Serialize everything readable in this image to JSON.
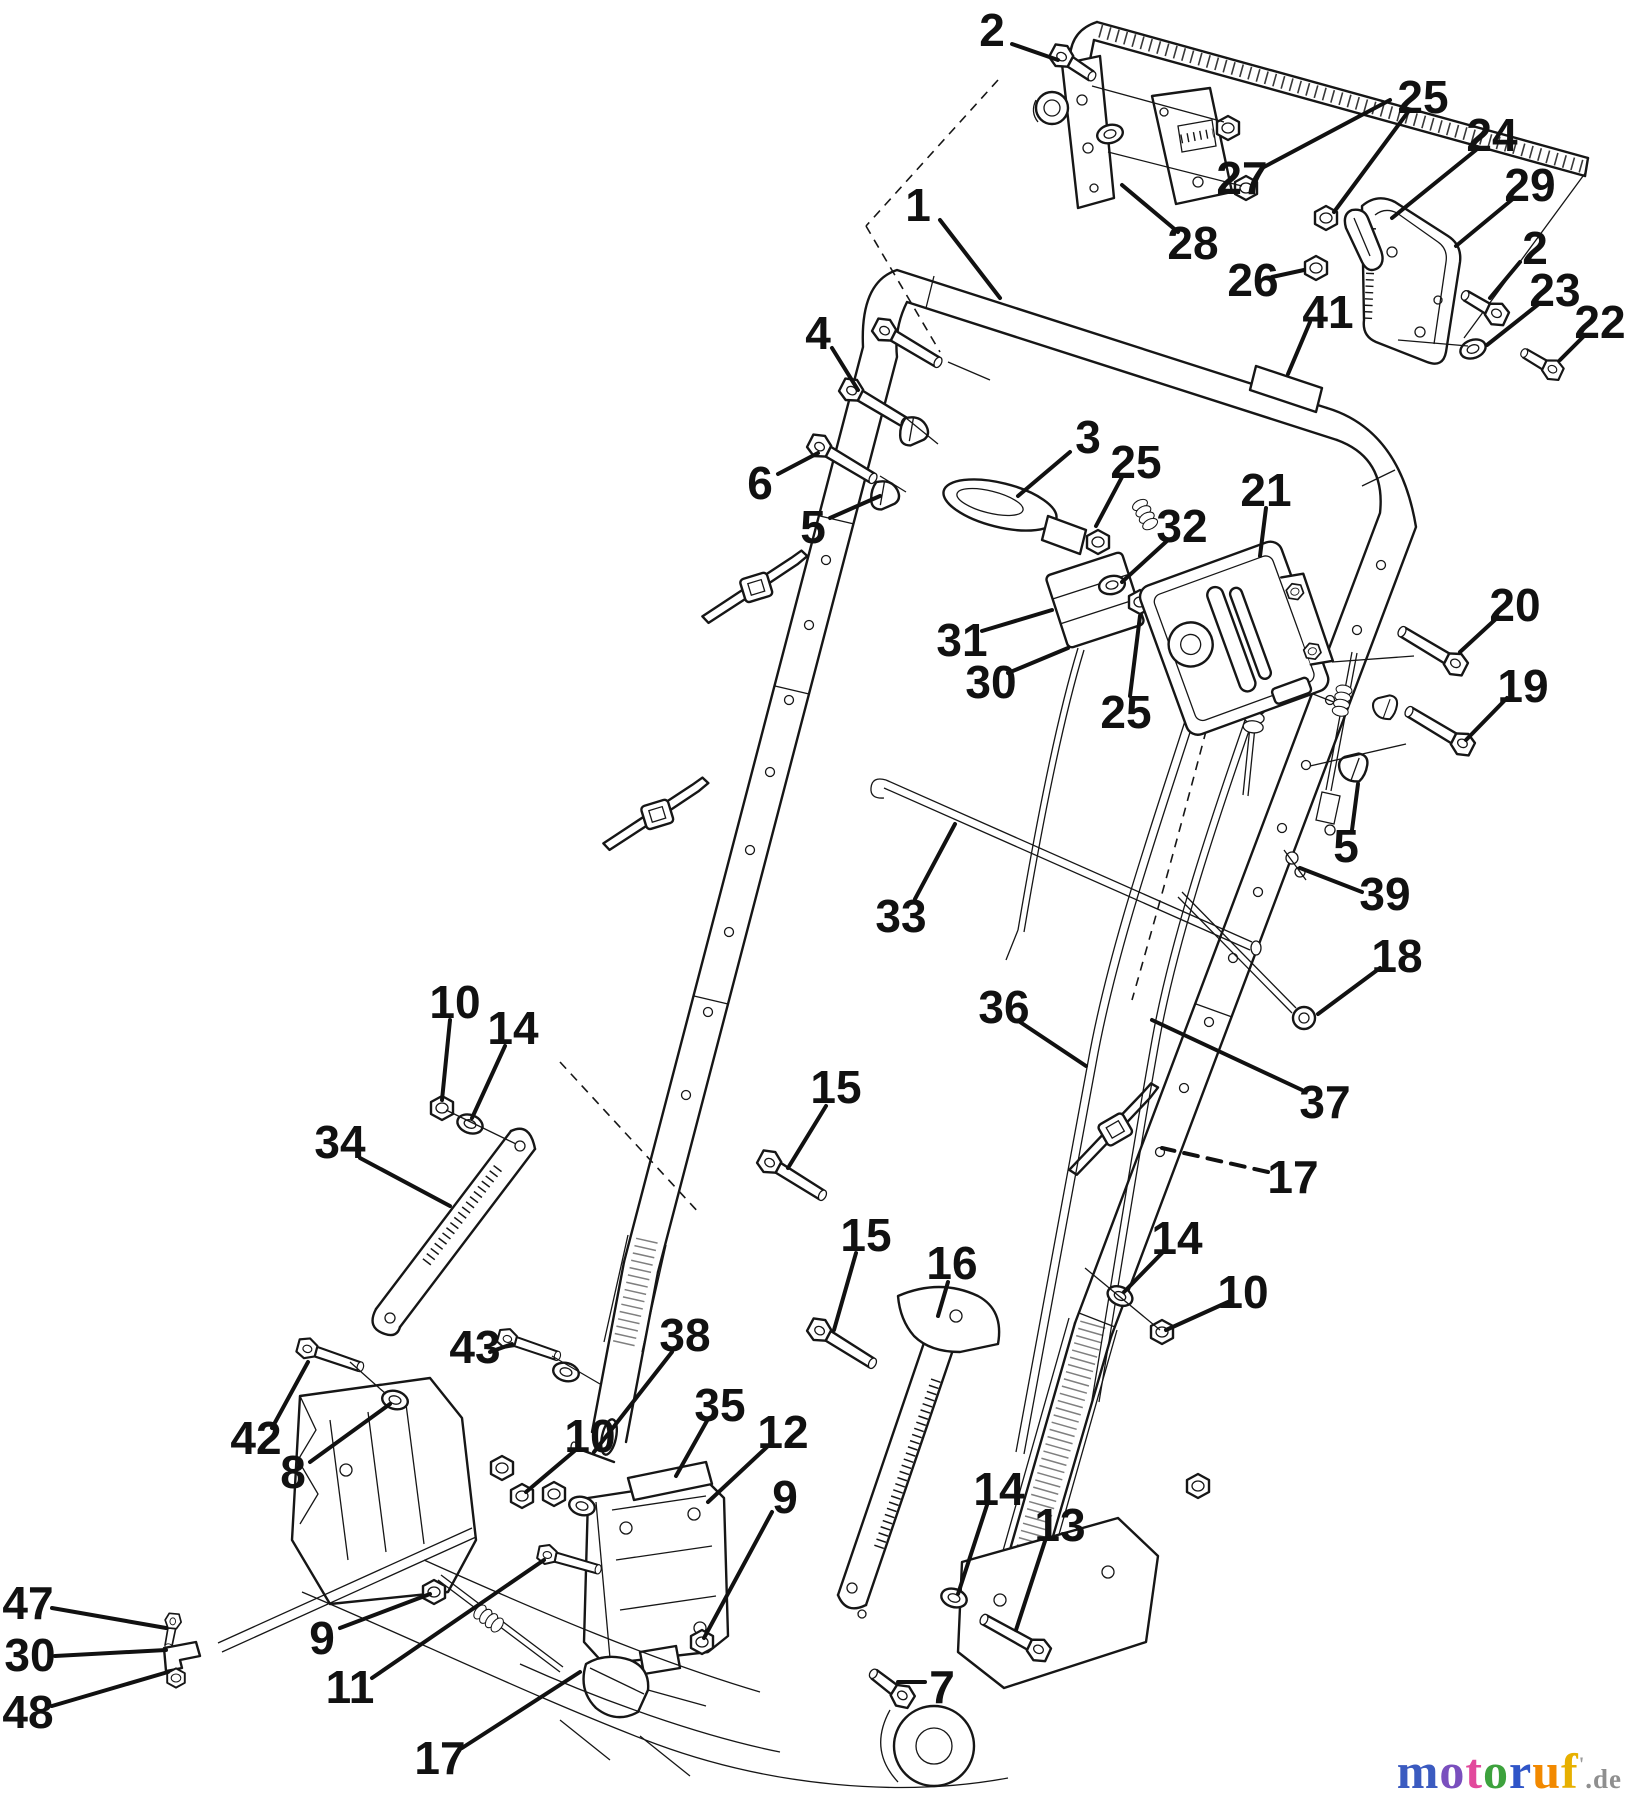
{
  "diagram": {
    "background": "#ffffff",
    "ink": "#161616",
    "callout_color": "#111111",
    "callouts": [
      {
        "part": "1",
        "x": 918,
        "y": 205,
        "leader": [
          [
            940,
            220
          ],
          [
            1000,
            298
          ]
        ]
      },
      {
        "part": "2",
        "x": 992,
        "y": 30,
        "leader": [
          [
            1012,
            44
          ],
          [
            1058,
            60
          ]
        ]
      },
      {
        "part": "2",
        "x": 1535,
        "y": 248,
        "leader": [
          [
            1520,
            262
          ],
          [
            1490,
            298
          ]
        ]
      },
      {
        "part": "3",
        "x": 1088,
        "y": 437,
        "leader": [
          [
            1070,
            452
          ],
          [
            1018,
            496
          ]
        ]
      },
      {
        "part": "4",
        "x": 818,
        "y": 333,
        "leader": [
          [
            832,
            348
          ],
          [
            858,
            390
          ]
        ]
      },
      {
        "part": "5",
        "x": 813,
        "y": 527,
        "leader": [
          [
            830,
            518
          ],
          [
            880,
            496
          ]
        ]
      },
      {
        "part": "5",
        "x": 1346,
        "y": 846,
        "leader": [
          [
            1352,
            830
          ],
          [
            1358,
            784
          ]
        ]
      },
      {
        "part": "6",
        "x": 760,
        "y": 483,
        "leader": [
          [
            778,
            474
          ],
          [
            818,
            453
          ]
        ]
      },
      {
        "part": "7",
        "x": 942,
        "y": 1687,
        "leader": [
          [
            925,
            1682
          ],
          [
            898,
            1682
          ]
        ]
      },
      {
        "part": "8",
        "x": 293,
        "y": 1472,
        "leader": [
          [
            310,
            1462
          ],
          [
            390,
            1404
          ]
        ]
      },
      {
        "part": "9",
        "x": 322,
        "y": 1638,
        "leader": [
          [
            340,
            1628
          ],
          [
            430,
            1594
          ]
        ]
      },
      {
        "part": "9",
        "x": 785,
        "y": 1497,
        "leader": [
          [
            772,
            1512
          ],
          [
            704,
            1638
          ]
        ]
      },
      {
        "part": "10",
        "x": 455,
        "y": 1002,
        "leader": [
          [
            450,
            1020
          ],
          [
            442,
            1100
          ]
        ]
      },
      {
        "part": "10",
        "x": 590,
        "y": 1436,
        "leader": [
          [
            578,
            1448
          ],
          [
            526,
            1492
          ]
        ]
      },
      {
        "part": "10",
        "x": 1243,
        "y": 1292,
        "leader": [
          [
            1228,
            1302
          ],
          [
            1166,
            1330
          ]
        ]
      },
      {
        "part": "11",
        "x": 350,
        "y": 1687,
        "leader": [
          [
            372,
            1678
          ],
          [
            544,
            1560
          ]
        ]
      },
      {
        "part": "12",
        "x": 783,
        "y": 1432,
        "leader": [
          [
            768,
            1446
          ],
          [
            708,
            1502
          ]
        ]
      },
      {
        "part": "13",
        "x": 1060,
        "y": 1525,
        "leader": [
          [
            1046,
            1538
          ],
          [
            1016,
            1630
          ]
        ]
      },
      {
        "part": "14",
        "x": 513,
        "y": 1028,
        "leader": [
          [
            505,
            1046
          ],
          [
            472,
            1118
          ]
        ]
      },
      {
        "part": "14",
        "x": 1177,
        "y": 1238,
        "leader": [
          [
            1165,
            1250
          ],
          [
            1124,
            1292
          ]
        ]
      },
      {
        "part": "14",
        "x": 999,
        "y": 1489,
        "leader": [
          [
            988,
            1502
          ],
          [
            958,
            1594
          ]
        ]
      },
      {
        "part": "15",
        "x": 836,
        "y": 1087,
        "leader": [
          [
            826,
            1106
          ],
          [
            788,
            1168
          ]
        ]
      },
      {
        "part": "15",
        "x": 866,
        "y": 1235,
        "leader": [
          [
            856,
            1253
          ],
          [
            834,
            1330
          ]
        ]
      },
      {
        "part": "16",
        "x": 952,
        "y": 1263,
        "leader": [
          [
            948,
            1282
          ],
          [
            938,
            1316
          ]
        ]
      },
      {
        "part": "17",
        "x": 1293,
        "y": 1177,
        "dashed": true,
        "leader": [
          [
            1268,
            1172
          ],
          [
            1162,
            1148
          ]
        ]
      },
      {
        "part": "17",
        "x": 440,
        "y": 1758,
        "leader": [
          [
            462,
            1748
          ],
          [
            580,
            1672
          ]
        ]
      },
      {
        "part": "18",
        "x": 1397,
        "y": 956,
        "leader": [
          [
            1380,
            968
          ],
          [
            1318,
            1014
          ]
        ]
      },
      {
        "part": "19",
        "x": 1523,
        "y": 686,
        "leader": [
          [
            1507,
            698
          ],
          [
            1466,
            740
          ]
        ]
      },
      {
        "part": "20",
        "x": 1515,
        "y": 605,
        "leader": [
          [
            1498,
            617
          ],
          [
            1460,
            652
          ]
        ]
      },
      {
        "part": "21",
        "x": 1266,
        "y": 490,
        "leader": [
          [
            1266,
            508
          ],
          [
            1260,
            556
          ]
        ]
      },
      {
        "part": "22",
        "x": 1600,
        "y": 322,
        "leader": [
          [
            1584,
            336
          ],
          [
            1560,
            360
          ]
        ]
      },
      {
        "part": "23",
        "x": 1555,
        "y": 290,
        "leader": [
          [
            1540,
            303
          ],
          [
            1487,
            345
          ]
        ]
      },
      {
        "part": "24",
        "x": 1492,
        "y": 135,
        "leader": [
          [
            1476,
            150
          ],
          [
            1392,
            218
          ]
        ]
      },
      {
        "part": "25",
        "x": 1423,
        "y": 97,
        "leader": [
          [
            1408,
            112
          ],
          [
            1334,
            212
          ]
        ]
      },
      {
        "part": "25",
        "x": 1136,
        "y": 462,
        "leader": [
          [
            1122,
            477
          ],
          [
            1096,
            526
          ]
        ]
      },
      {
        "part": "25",
        "x": 1126,
        "y": 712,
        "leader": [
          [
            1130,
            696
          ],
          [
            1140,
            616
          ]
        ]
      },
      {
        "part": "26",
        "x": 1253,
        "y": 280,
        "leader": [
          [
            1272,
            277
          ],
          [
            1304,
            270
          ]
        ]
      },
      {
        "part": "27",
        "x": 1242,
        "y": 178,
        "leader": [
          [
            1262,
            168
          ],
          [
            1390,
            100
          ]
        ]
      },
      {
        "part": "28",
        "x": 1193,
        "y": 243,
        "leader": [
          [
            1178,
            232
          ],
          [
            1122,
            185
          ]
        ]
      },
      {
        "part": "29",
        "x": 1530,
        "y": 185,
        "leader": [
          [
            1514,
            198
          ],
          [
            1456,
            246
          ]
        ]
      },
      {
        "part": "30",
        "x": 991,
        "y": 682,
        "leader": [
          [
            1008,
            673
          ],
          [
            1068,
            648
          ]
        ]
      },
      {
        "part": "30",
        "x": 30,
        "y": 1655,
        "leader": [
          [
            55,
            1656
          ],
          [
            166,
            1650
          ]
        ]
      },
      {
        "part": "31",
        "x": 962,
        "y": 640,
        "leader": [
          [
            982,
            631
          ],
          [
            1052,
            610
          ]
        ]
      },
      {
        "part": "32",
        "x": 1182,
        "y": 526,
        "leader": [
          [
            1168,
            540
          ],
          [
            1122,
            582
          ]
        ]
      },
      {
        "part": "33",
        "x": 901,
        "y": 916,
        "leader": [
          [
            915,
            899
          ],
          [
            955,
            824
          ]
        ]
      },
      {
        "part": "34",
        "x": 340,
        "y": 1142,
        "leader": [
          [
            360,
            1158
          ],
          [
            450,
            1206
          ]
        ]
      },
      {
        "part": "35",
        "x": 720,
        "y": 1405,
        "leader": [
          [
            708,
            1419
          ],
          [
            676,
            1476
          ]
        ]
      },
      {
        "part": "36",
        "x": 1004,
        "y": 1007,
        "leader": [
          [
            1020,
            1022
          ],
          [
            1086,
            1066
          ]
        ]
      },
      {
        "part": "37",
        "x": 1325,
        "y": 1102,
        "leader": [
          [
            1302,
            1090
          ],
          [
            1152,
            1020
          ]
        ]
      },
      {
        "part": "38",
        "x": 685,
        "y": 1335,
        "leader": [
          [
            672,
            1352
          ],
          [
            594,
            1452
          ]
        ]
      },
      {
        "part": "39",
        "x": 1385,
        "y": 894,
        "leader": [
          [
            1362,
            892
          ],
          [
            1300,
            868
          ]
        ]
      },
      {
        "part": "41",
        "x": 1328,
        "y": 312,
        "leader": [
          [
            1310,
            322
          ],
          [
            1288,
            374
          ]
        ]
      },
      {
        "part": "42",
        "x": 256,
        "y": 1438,
        "leader": [
          [
            272,
            1428
          ],
          [
            308,
            1362
          ]
        ]
      },
      {
        "part": "43",
        "x": 475,
        "y": 1347,
        "leader": [
          [
            490,
            1352
          ],
          [
            512,
            1344
          ]
        ]
      },
      {
        "part": "47",
        "x": 28,
        "y": 1603,
        "leader": [
          [
            52,
            1608
          ],
          [
            166,
            1628
          ]
        ]
      },
      {
        "part": "48",
        "x": 28,
        "y": 1712,
        "leader": [
          [
            52,
            1706
          ],
          [
            168,
            1672
          ]
        ]
      }
    ]
  },
  "watermark": {
    "letters": [
      {
        "ch": "m",
        "color": "#3b5bc0"
      },
      {
        "ch": "o",
        "color": "#7a4fbe"
      },
      {
        "ch": "t",
        "color": "#e2499c"
      },
      {
        "ch": "o",
        "color": "#3da23d"
      },
      {
        "ch": "r",
        "color": "#2f55c8"
      },
      {
        "ch": "u",
        "color": "#f28900"
      },
      {
        "ch": "f",
        "color": "#e7b000"
      }
    ],
    "tick": "'",
    "tick_color": "#9a9a9a",
    "suffix": ".de",
    "suffix_color": "#8f8f8f"
  }
}
